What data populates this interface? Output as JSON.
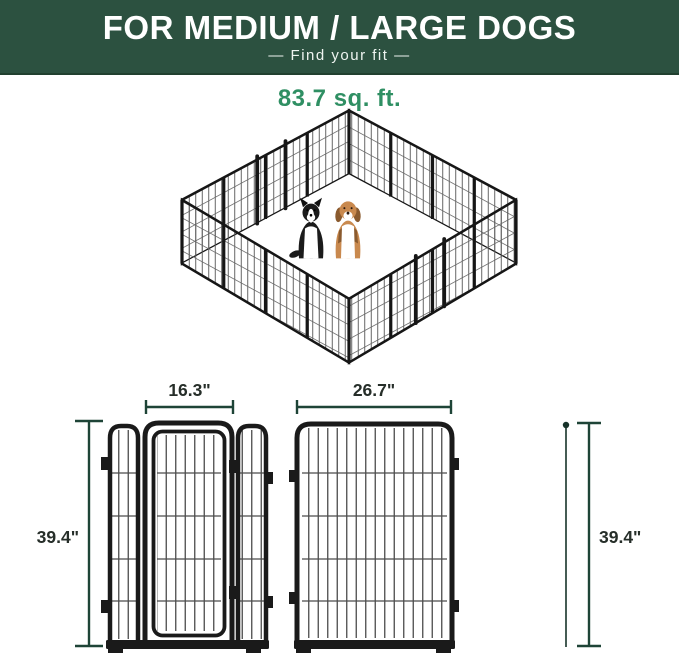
{
  "header": {
    "title": "FOR MEDIUM / LARGE DOGS",
    "subtitle": "—  Find your fit  —",
    "bg_color": "#2c5140",
    "text_color": "#ffffff"
  },
  "pen": {
    "area_label": "83.7 sq. ft.",
    "area_label_color": "#2f8f63",
    "panel_count_per_side": 4,
    "dogs": [
      "border-collie",
      "beagle"
    ],
    "frame_color": "#161616",
    "mesh_color": "#555555"
  },
  "dimensions": {
    "door_width_label": "16.3\"",
    "panel_width_label": "26.7\"",
    "height_left_label": "39.4\"",
    "height_right_label": "39.4\"",
    "line_color": "#1e4437",
    "label_color": "#262e29"
  }
}
